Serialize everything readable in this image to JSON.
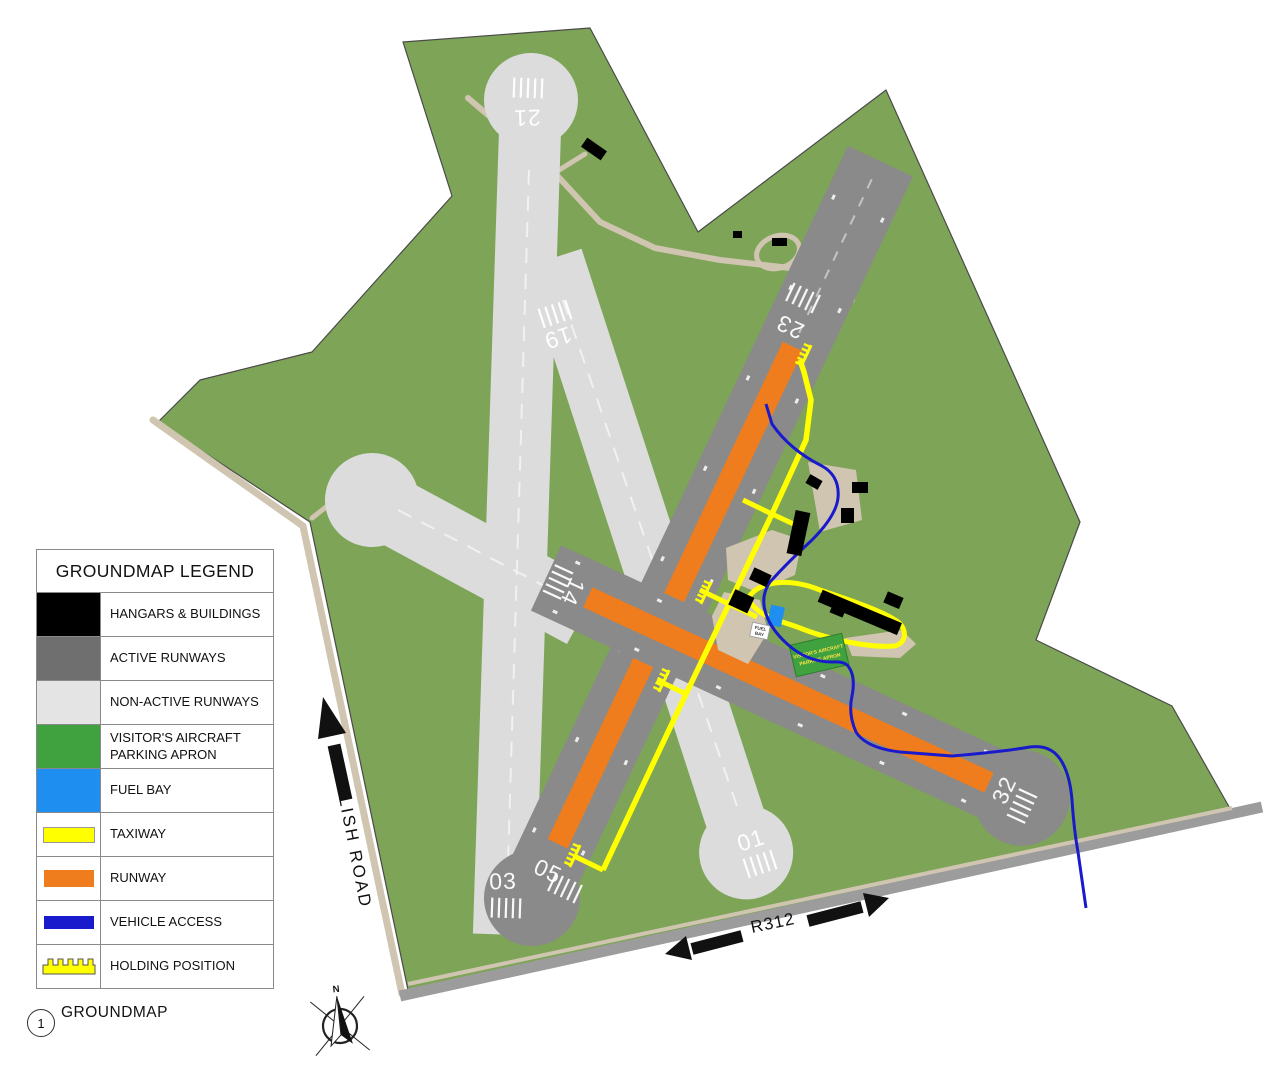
{
  "figure": {
    "number": "1",
    "title": "GROUNDMAP"
  },
  "legend": {
    "title": "GROUNDMAP LEGEND",
    "items": [
      {
        "label": "HANGARS & BUILDINGS",
        "color": "#000000",
        "swatch": "fill"
      },
      {
        "label": "ACTIVE RUNWAYS",
        "color": "#6f6f6f",
        "swatch": "fill"
      },
      {
        "label": "NON-ACTIVE RUNWAYS",
        "color": "#e4e4e4",
        "swatch": "fill"
      },
      {
        "label": "VISITOR'S AIRCRAFT PARKING APRON",
        "color": "#3fa23e",
        "swatch": "fill"
      },
      {
        "label": "FUEL BAY",
        "color": "#1e8ef0",
        "swatch": "fill"
      },
      {
        "label": "TAXIWAY",
        "color": "#ffff00",
        "swatch": "bar"
      },
      {
        "label": "RUNWAY",
        "color": "#ef7d1d",
        "swatch": "bar"
      },
      {
        "label": "VEHICLE ACCESS",
        "color": "#1a1acd",
        "swatch": "bar"
      },
      {
        "label": "HOLDING POSITION",
        "color": "#ffff00",
        "swatch": "comb"
      }
    ]
  },
  "map": {
    "runway_labels": {
      "r21": "21",
      "r19": "19",
      "r23": "23",
      "r14": "14",
      "r01": "01",
      "r03": "03",
      "r05": "05",
      "r32": "32"
    },
    "roads": {
      "left_road": "MELLISH ROAD",
      "bottom_road": "R312"
    },
    "compass_north": "N",
    "visitor_apron_sign": {
      "line1": "VISITOR'S AIRCRAFT",
      "line2": "PARKING APRON"
    },
    "fuel_bay_sign": {
      "line1": "FUEL",
      "line2": "BAY"
    }
  },
  "colors": {
    "field_green": "#7da457",
    "active_runway": "#8a8a8a",
    "non_active_runway": "#dcdcdc",
    "runway_strip": "#ef7d1d",
    "taxiway": "#ffff00",
    "vehicle_access": "#1a1acd",
    "fuel_bay": "#1e8ef0",
    "visitor_apron": "#3fa23e",
    "dirt_road": "#cfc5b0",
    "paved_road": "#9c9c9c"
  }
}
